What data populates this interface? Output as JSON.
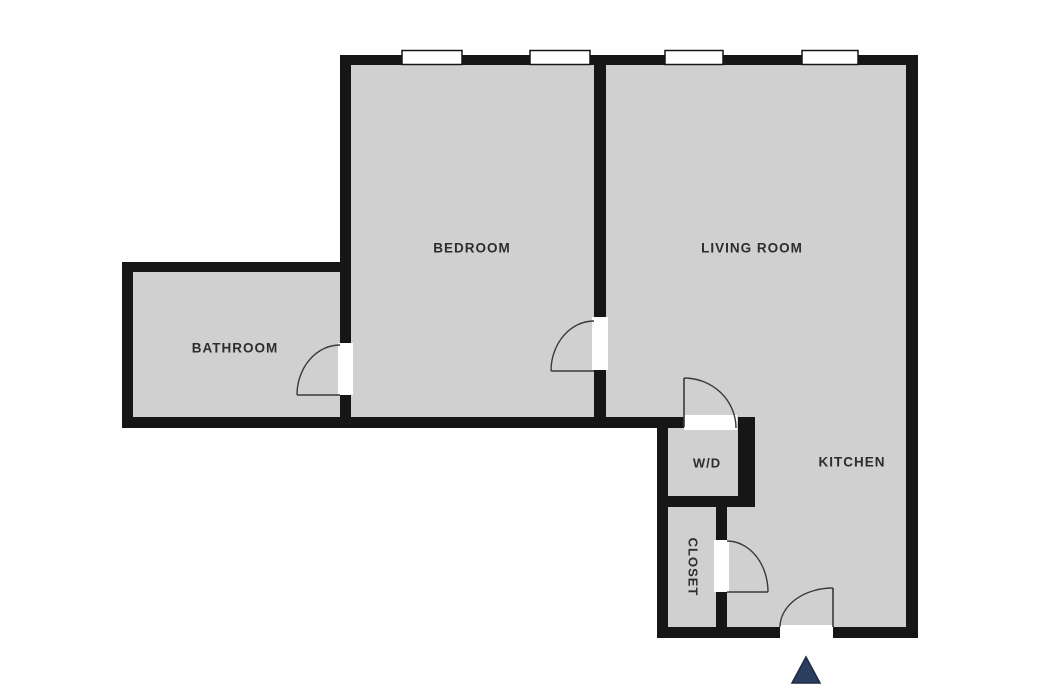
{
  "title": "apartment-floor-plan",
  "canvas": {
    "width": 1039,
    "height": 689
  },
  "colors": {
    "background": "#ffffff",
    "floor_fill": "#d0d0d0",
    "wall": "#161616",
    "opening": "#ffffff",
    "window_border": "#161616",
    "door_arc": "#3a3a3a",
    "label_text": "#2d2d2d",
    "entrance_marker": "#2c3e60",
    "entrance_marker_border": "#1e2a40"
  },
  "rooms": [
    {
      "id": "bedroom",
      "label": "BEDROOM",
      "label_x": 472,
      "label_y": 249,
      "rotation": 0,
      "font_size": 13.5
    },
    {
      "id": "living-room",
      "label": "LIVING ROOM",
      "label_x": 752,
      "label_y": 249,
      "rotation": 0,
      "font_size": 13.5
    },
    {
      "id": "bathroom",
      "label": "BATHROOM",
      "label_x": 235,
      "label_y": 349,
      "rotation": 0,
      "font_size": 13.5
    },
    {
      "id": "wd",
      "label": "W/D",
      "label_x": 707,
      "label_y": 464,
      "rotation": 0,
      "font_size": 13
    },
    {
      "id": "kitchen",
      "label": "KITCHEN",
      "label_x": 852,
      "label_y": 463,
      "rotation": 0,
      "font_size": 13.5
    },
    {
      "id": "closet",
      "label": "CLOSET",
      "label_x": 692,
      "label_y": 567,
      "rotation": 90,
      "font_size": 13
    }
  ],
  "floor_outline": "M 340,55 L 918,55 L 918,638 L 657,638 L 657,428 L 122,428 L 122,262 L 340,262 Z",
  "walls": [
    {
      "id": "wall-top",
      "x": 340,
      "y": 55,
      "w": 578,
      "h": 10
    },
    {
      "id": "wall-right",
      "x": 906,
      "y": 55,
      "w": 12,
      "h": 583
    },
    {
      "id": "wall-bottom-kitchen",
      "x": 657,
      "y": 627,
      "w": 261,
      "h": 11
    },
    {
      "id": "wall-bedroom-left",
      "x": 340,
      "y": 55,
      "w": 11,
      "h": 373
    },
    {
      "id": "wall-divider-bedroom-living",
      "x": 594,
      "y": 55,
      "w": 12,
      "h": 373
    },
    {
      "id": "wall-bathroom-top",
      "x": 122,
      "y": 262,
      "w": 229,
      "h": 10
    },
    {
      "id": "wall-bathroom-left",
      "x": 122,
      "y": 262,
      "w": 11,
      "h": 166
    },
    {
      "id": "wall-main-horizontal",
      "x": 122,
      "y": 417,
      "w": 562,
      "h": 11
    },
    {
      "id": "wall-wd-closet-left",
      "x": 657,
      "y": 417,
      "w": 11,
      "h": 221
    },
    {
      "id": "wall-wd-bottom",
      "x": 657,
      "y": 496,
      "w": 98,
      "h": 11
    },
    {
      "id": "wall-wd-right",
      "x": 738,
      "y": 417,
      "w": 17,
      "h": 90
    },
    {
      "id": "wall-closet-right",
      "x": 716,
      "y": 496,
      "w": 11,
      "h": 142
    }
  ],
  "door_openings": [
    {
      "id": "opening-bathroom-door",
      "x": 338,
      "y": 343,
      "w": 15,
      "h": 52
    },
    {
      "id": "opening-bedroom-door",
      "x": 592,
      "y": 317,
      "w": 16,
      "h": 53
    },
    {
      "id": "opening-wd-door",
      "x": 684,
      "y": 415,
      "w": 53,
      "h": 15
    },
    {
      "id": "opening-closet-door",
      "x": 714,
      "y": 540,
      "w": 15,
      "h": 52
    },
    {
      "id": "opening-entry-door",
      "x": 780,
      "y": 625,
      "w": 53,
      "h": 15
    }
  ],
  "windows": [
    {
      "id": "window-1",
      "x": 402,
      "y": 50.5,
      "w": 60,
      "h": 14
    },
    {
      "id": "window-2",
      "x": 530,
      "y": 50.5,
      "w": 60,
      "h": 14
    },
    {
      "id": "window-3",
      "x": 665,
      "y": 50.5,
      "w": 58,
      "h": 14
    },
    {
      "id": "window-4",
      "x": 802,
      "y": 50.5,
      "w": 56,
      "h": 14
    }
  ],
  "doors": [
    {
      "id": "door-bathroom",
      "leaf": "M 297,395 L 340,395",
      "arc": "M 297,395 A 43,50 0 0 1 340,345"
    },
    {
      "id": "door-bedroom",
      "leaf": "M 551,371 L 594,371",
      "arc": "M 551,371 A 43,50 0 0 1 594,321"
    },
    {
      "id": "door-wd",
      "leaf": "M 684,378 L 684,427",
      "arc": "M 684,378 A 52,50 0 0 1 736,428"
    },
    {
      "id": "door-closet",
      "leaf": "M 727,592 L 768,592",
      "arc": "M 727,541 A 41,51 0 0 1 768,592"
    },
    {
      "id": "door-entry",
      "leaf": "M 833,588 L 833,627",
      "arc": "M 780,627 A 53,39 0 0 1 833,588"
    }
  ],
  "entrance_marker": {
    "id": "entrance-triangle",
    "points": "806,657 820,683 792,683"
  }
}
